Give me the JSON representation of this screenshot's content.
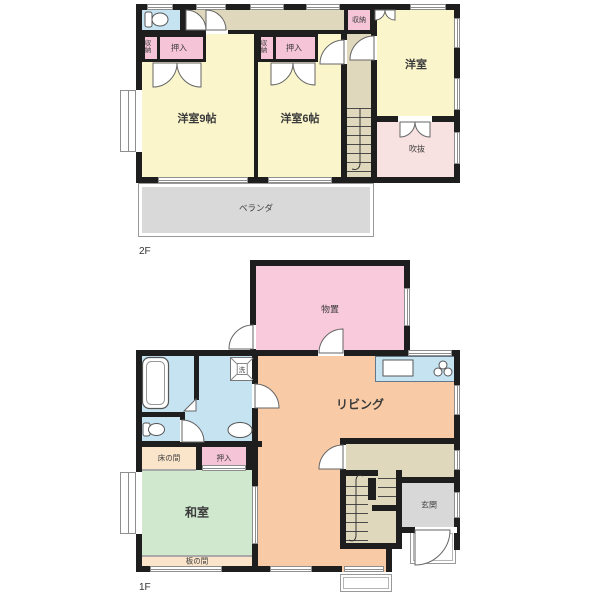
{
  "colors": {
    "wall": "#1e1e1e",
    "western": "#faf5cb",
    "hall": "#e0d8bc",
    "closet": "#f5c4d7",
    "storeroom": "#f8cadb",
    "voidroom": "#f8e1e1",
    "balcony": "#d9d9d9",
    "water": "#c6e3f2",
    "tatami": "#cfe8ce",
    "living": "#f8cba6",
    "cream": "#fae4ca",
    "entrance": "#d8d8d8"
  },
  "floor2": {
    "label": "2F",
    "rooms": {
      "western9": "洋室9帖",
      "western6": "洋室6帖",
      "western": "洋室",
      "void": "吹抜",
      "balcony": "ベランダ",
      "closet_a": "押入",
      "closet_b": "押入",
      "storage_a": "収納",
      "storage_b": "収納",
      "storage_top": "収納"
    }
  },
  "floor1": {
    "label": "1F",
    "rooms": {
      "storeroom": "物置",
      "living": "リビング",
      "japanese": "和室",
      "tokonoma": "床の間",
      "closet": "押入",
      "itanoma": "板の間",
      "entrance": "玄関",
      "laundry": "洗"
    }
  }
}
